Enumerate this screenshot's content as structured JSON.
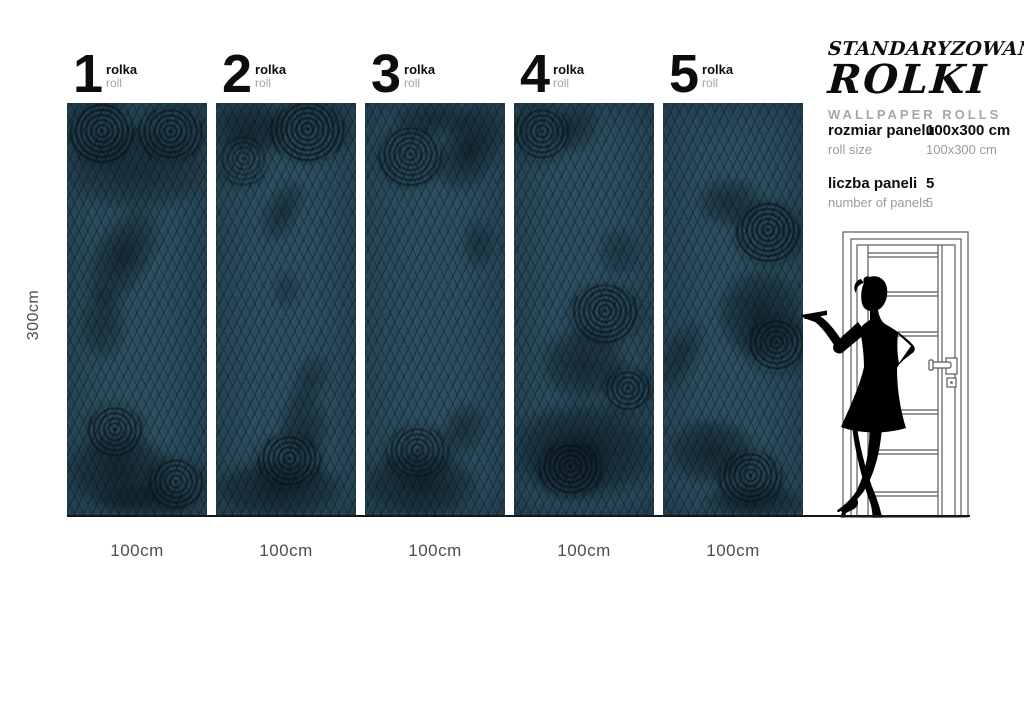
{
  "title_block": {
    "line1": "STANDARYZOWANE",
    "line2": "ROLKI",
    "subtitle": "WALLPAPER ROLLS"
  },
  "specs": [
    {
      "label_pl": "rozmiar panelu",
      "label_en": "roll size",
      "value_pl": "100x300 cm",
      "value_en": "100x300 cm"
    },
    {
      "label_pl": "liczba paneli",
      "label_en": "number of panels",
      "value_pl": "5",
      "value_en": "5"
    }
  ],
  "dimensions": {
    "height_label": "300cm",
    "width_label": "100cm"
  },
  "panels": [
    {
      "number": "1",
      "label_pl": "rolka",
      "label_en": "roll",
      "width_label": "100cm",
      "florals": [
        {
          "t": "rose",
          "x": 2,
          "y": 0,
          "w": 46,
          "h": 15,
          "o": 0.9
        },
        {
          "t": "rose",
          "x": 50,
          "y": 1,
          "w": 48,
          "h": 13,
          "o": 0.85
        },
        {
          "t": "blob",
          "x": 0,
          "y": 6,
          "w": 100,
          "h": 20,
          "o": 0.55
        },
        {
          "t": "sprig",
          "x": 20,
          "y": 24,
          "w": 40,
          "h": 26,
          "o": 0.7
        },
        {
          "t": "blob",
          "x": 10,
          "y": 44,
          "w": 32,
          "h": 18,
          "o": 0.45
        },
        {
          "t": "rose",
          "x": 14,
          "y": 73,
          "w": 40,
          "h": 13,
          "o": 0.8
        },
        {
          "t": "blob",
          "x": 0,
          "y": 80,
          "w": 75,
          "h": 18,
          "o": 0.7
        },
        {
          "t": "rose",
          "x": 58,
          "y": 86,
          "w": 40,
          "h": 12,
          "o": 0.8
        },
        {
          "t": "blob",
          "x": 20,
          "y": 92,
          "w": 70,
          "h": 8,
          "o": 0.6
        }
      ]
    },
    {
      "number": "2",
      "label_pl": "rolka",
      "label_en": "roll",
      "width_label": "100cm",
      "florals": [
        {
          "t": "rose",
          "x": 38,
          "y": 0,
          "w": 55,
          "h": 14,
          "o": 0.9
        },
        {
          "t": "blob",
          "x": 0,
          "y": 0,
          "w": 50,
          "h": 12,
          "o": 0.6
        },
        {
          "t": "rose",
          "x": 2,
          "y": 8,
          "w": 35,
          "h": 12,
          "o": 0.6
        },
        {
          "t": "sprig",
          "x": 35,
          "y": 18,
          "w": 25,
          "h": 16,
          "o": 0.55
        },
        {
          "t": "blob",
          "x": 40,
          "y": 40,
          "w": 20,
          "h": 10,
          "o": 0.3
        },
        {
          "t": "sprig",
          "x": 55,
          "y": 60,
          "w": 25,
          "h": 14,
          "o": 0.45
        },
        {
          "t": "rose",
          "x": 30,
          "y": 80,
          "w": 45,
          "h": 13,
          "o": 0.85
        },
        {
          "t": "blob",
          "x": 0,
          "y": 86,
          "w": 90,
          "h": 14,
          "o": 0.7
        },
        {
          "t": "blob",
          "x": 45,
          "y": 70,
          "w": 35,
          "h": 16,
          "o": 0.5
        }
      ]
    },
    {
      "number": "3",
      "label_pl": "rolka",
      "label_en": "roll",
      "width_label": "100cm",
      "florals": [
        {
          "t": "rose",
          "x": 10,
          "y": 6,
          "w": 45,
          "h": 14,
          "o": 0.8
        },
        {
          "t": "sprig",
          "x": 55,
          "y": 0,
          "w": 40,
          "h": 22,
          "o": 0.75
        },
        {
          "t": "blob",
          "x": 20,
          "y": 0,
          "w": 60,
          "h": 8,
          "o": 0.5
        },
        {
          "t": "blob",
          "x": 70,
          "y": 28,
          "w": 22,
          "h": 12,
          "o": 0.4
        },
        {
          "t": "rose",
          "x": 15,
          "y": 78,
          "w": 45,
          "h": 13,
          "o": 0.75
        },
        {
          "t": "blob",
          "x": 0,
          "y": 84,
          "w": 80,
          "h": 16,
          "o": 0.7
        },
        {
          "t": "sprig",
          "x": 55,
          "y": 72,
          "w": 30,
          "h": 14,
          "o": 0.5
        }
      ]
    },
    {
      "number": "4",
      "label_pl": "rolka",
      "label_en": "roll",
      "width_label": "100cm",
      "florals": [
        {
          "t": "rose",
          "x": 0,
          "y": 1,
          "w": 40,
          "h": 13,
          "o": 0.8
        },
        {
          "t": "sprig",
          "x": 30,
          "y": 0,
          "w": 30,
          "h": 12,
          "o": 0.5
        },
        {
          "t": "blob",
          "x": 60,
          "y": 30,
          "w": 30,
          "h": 12,
          "o": 0.35
        },
        {
          "t": "rose",
          "x": 40,
          "y": 44,
          "w": 50,
          "h": 14,
          "o": 0.85
        },
        {
          "t": "blob",
          "x": 20,
          "y": 54,
          "w": 60,
          "h": 18,
          "o": 0.6
        },
        {
          "t": "blob",
          "x": 0,
          "y": 72,
          "w": 100,
          "h": 24,
          "o": 0.75
        },
        {
          "t": "rose",
          "x": 18,
          "y": 82,
          "w": 45,
          "h": 13,
          "o": 0.9
        },
        {
          "t": "rose",
          "x": 65,
          "y": 64,
          "w": 33,
          "h": 11,
          "o": 0.8
        }
      ]
    },
    {
      "number": "5",
      "label_pl": "rolka",
      "label_en": "roll",
      "width_label": "100cm",
      "florals": [
        {
          "t": "blob",
          "x": 25,
          "y": 18,
          "w": 45,
          "h": 12,
          "o": 0.5
        },
        {
          "t": "rose",
          "x": 52,
          "y": 24,
          "w": 46,
          "h": 15,
          "o": 0.9
        },
        {
          "t": "blob",
          "x": 40,
          "y": 40,
          "w": 58,
          "h": 22,
          "o": 0.65
        },
        {
          "t": "rose",
          "x": 60,
          "y": 52,
          "w": 42,
          "h": 13,
          "o": 0.85
        },
        {
          "t": "sprig",
          "x": 0,
          "y": 52,
          "w": 26,
          "h": 18,
          "o": 0.5
        },
        {
          "t": "blob",
          "x": 5,
          "y": 76,
          "w": 60,
          "h": 16,
          "o": 0.65
        },
        {
          "t": "rose",
          "x": 40,
          "y": 84,
          "w": 45,
          "h": 13,
          "o": 0.85
        },
        {
          "t": "blob",
          "x": 30,
          "y": 92,
          "w": 68,
          "h": 8,
          "o": 0.6
        }
      ]
    }
  ],
  "illustrations": {
    "door": "door-outline",
    "figure": "presenting-woman-silhouette"
  },
  "colors": {
    "wallpaper_teal": "#2b4d5e",
    "lattice_dark": "#0e1e27",
    "floral_dark": "#071016",
    "text_black": "#0d0d0d",
    "text_gray": "#a6a6a6",
    "dim_gray": "#4d4d4d",
    "door_line": "#5a5a5a",
    "background": "#ffffff"
  }
}
